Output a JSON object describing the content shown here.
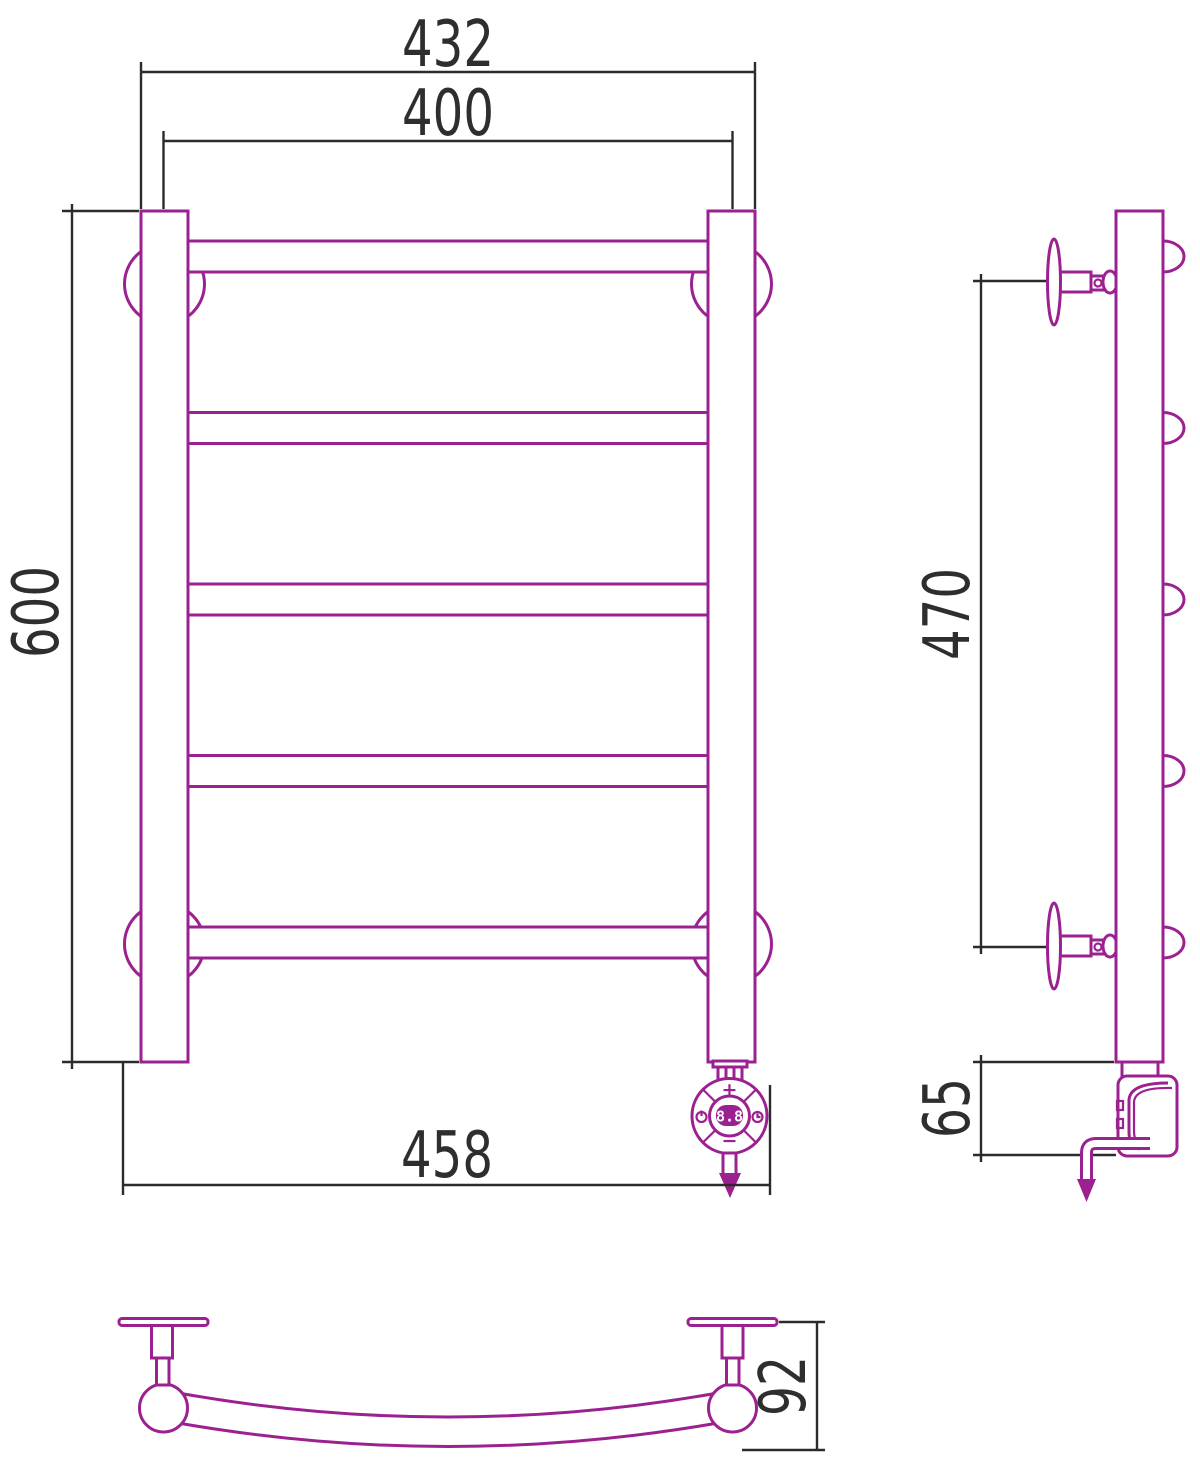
{
  "title": "Heated towel rail — technical drawing, three views",
  "colors": {
    "product_line": "#9C2190",
    "dimension_line": "#2B2B2B",
    "display_text": "#FFFFFF",
    "background": "#FFFFFF"
  },
  "views": {
    "front": {
      "dims": {
        "outer_width": "432",
        "axis_width": "400",
        "height": "600",
        "overall_width": "458"
      }
    },
    "side": {
      "dims": {
        "mount_span": "470",
        "heater_depth": "65"
      }
    },
    "top": {
      "dims": {
        "depth": "92"
      }
    }
  },
  "controller": {
    "display": "8.8",
    "plus_label": "+",
    "minus_label": "−"
  }
}
